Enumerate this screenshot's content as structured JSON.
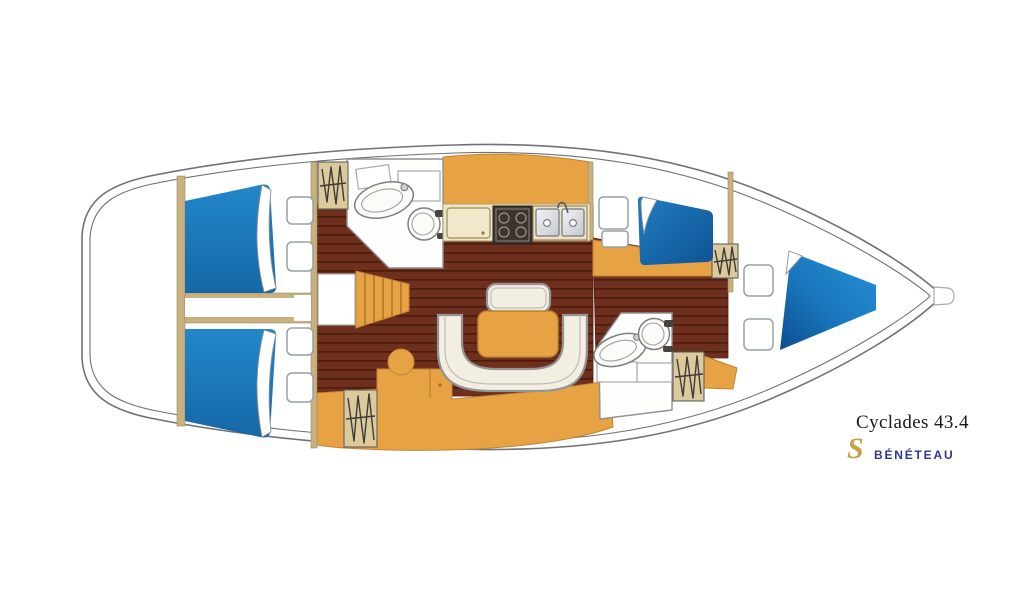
{
  "branding": {
    "model": "Cyclades 43.4",
    "brand": "BÉNÉTEAU",
    "logo_glyph": "S"
  },
  "palette": {
    "background": "#ffffff",
    "hull_line": "#70717a",
    "outline_gray": "#8f9094",
    "wall_tan": "#c9b07f",
    "wardrobe_tan": "#dcc99c",
    "floor_brown": "#6f2f1e",
    "floor_plank": "#4e1c0c",
    "cabinet_orange": "#e7a343",
    "berth_blue": "#1e80c2",
    "berth_blue_dark": "#0f5292",
    "counter_cream": "#f0e4c6",
    "settee_cream": "#f2eee2",
    "brand_blue": "#2b3a8c",
    "logo_gold": "#c9a04a"
  }
}
